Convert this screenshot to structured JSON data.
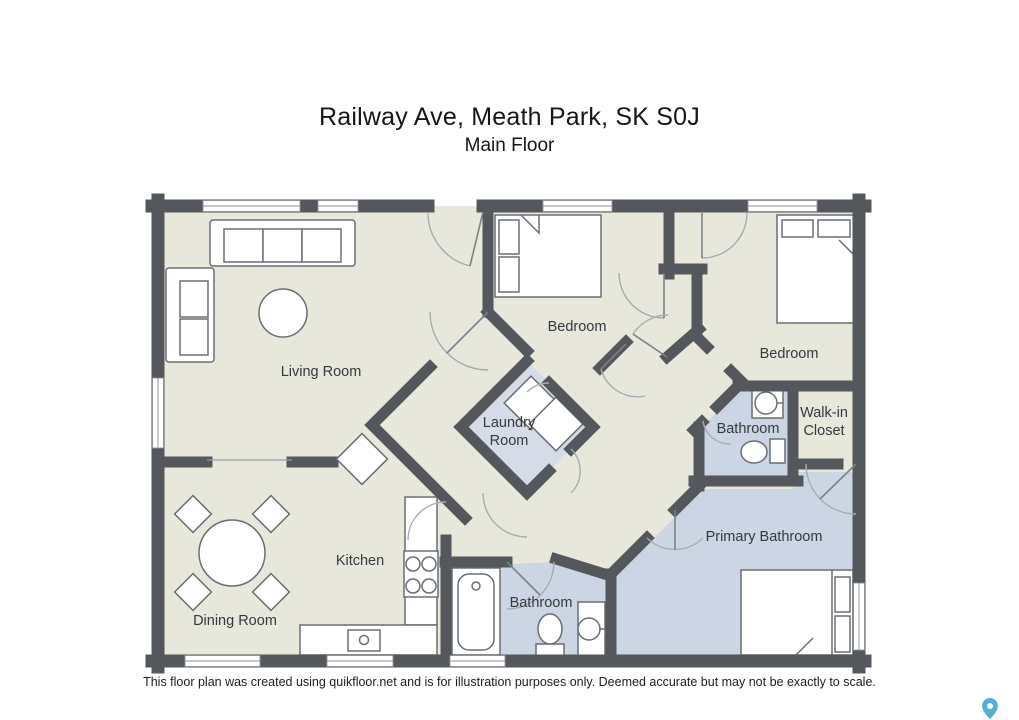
{
  "header": {
    "title": "Railway Ave, Meath Park, SK S0J",
    "subtitle": "Main Floor"
  },
  "rooms": {
    "living": {
      "label": "Living Room"
    },
    "bedroom_middle": {
      "label": "Bedroom"
    },
    "bedroom_right": {
      "label": "Bedroom"
    },
    "laundry": {
      "line1": "Laundry",
      "line2": "Room"
    },
    "bathroom_upper": {
      "label": "Bathroom"
    },
    "walk_in_closet": {
      "line1": "Walk-in",
      "line2": "Closet"
    },
    "primary_bathroom": {
      "label": "Primary Bathroom"
    },
    "bathroom_lower": {
      "label": "Bathroom"
    },
    "kitchen": {
      "label": "Kitchen"
    },
    "dining": {
      "label": "Dining Room"
    }
  },
  "footer": {
    "disclaimer": "This floor plan was created using quikfloor.net and is for illustration purposes only. Deemed accurate but may not be exactly to scale."
  },
  "colors": {
    "wall": "#54575c",
    "floor": "#e7e7dc",
    "wet_floor": "#ccd5e3",
    "laundry_floor": "#d5dbe7",
    "pin": "#53aed8"
  },
  "icons": {
    "map_pin": "map-pin-icon"
  }
}
